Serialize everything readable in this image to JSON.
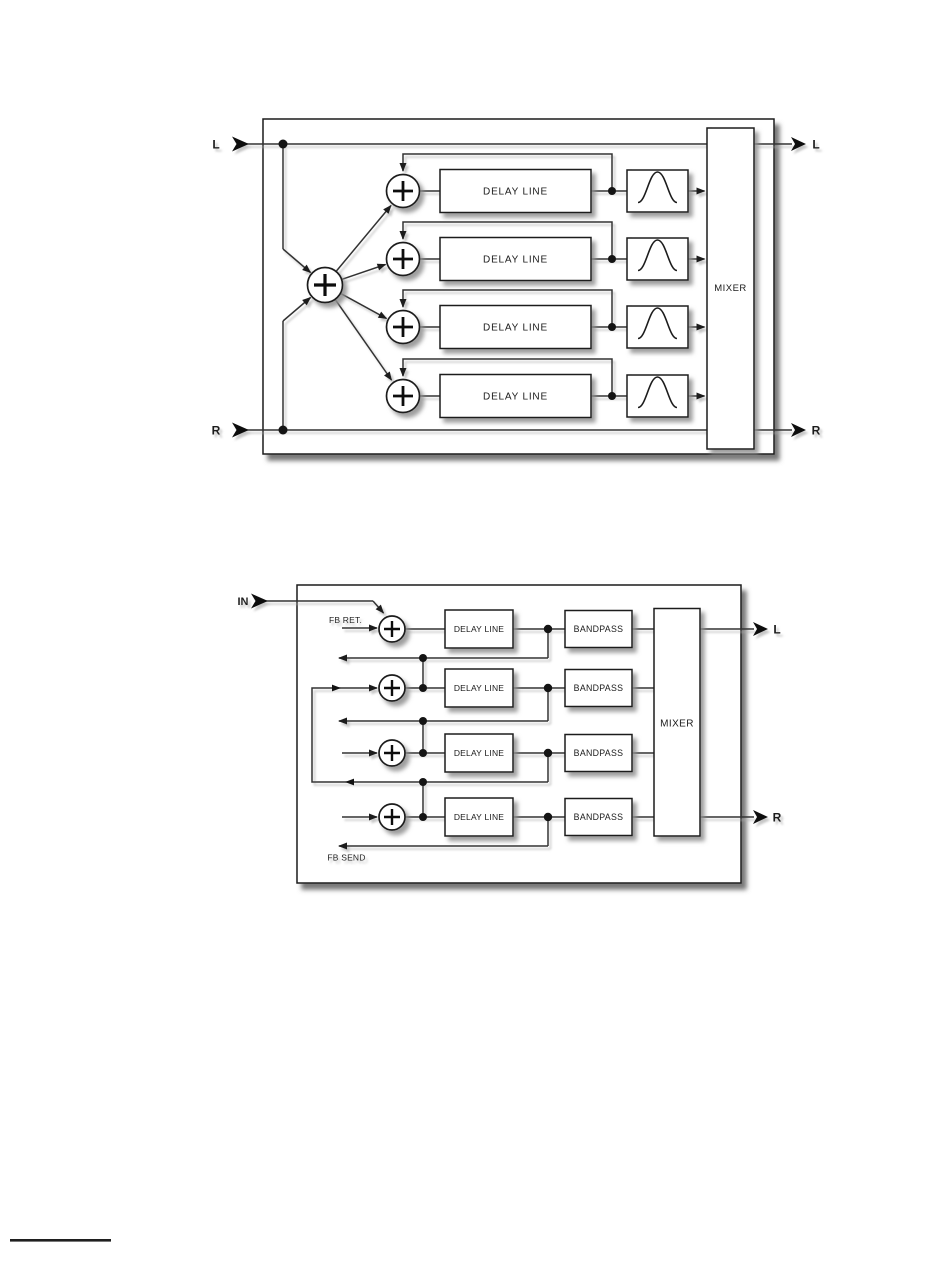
{
  "colors": {
    "background": "#ffffff",
    "line": "#333333",
    "box_stroke": "#1c1c1c",
    "box_fill": "#ffffff",
    "text": "#1a1a1a",
    "shadow": "#8d8d8d"
  },
  "diagram_top": {
    "inputs": {
      "top": "L",
      "bottom": "R"
    },
    "outputs": {
      "top": "L",
      "bottom": "R"
    },
    "summing_symbol": "+",
    "rows": [
      {
        "delay_label": "DELAY LINE",
        "filter_icon": "bandpass-curve-icon"
      },
      {
        "delay_label": "DELAY LINE",
        "filter_icon": "bandpass-curve-icon"
      },
      {
        "delay_label": "DELAY LINE",
        "filter_icon": "bandpass-curve-icon"
      },
      {
        "delay_label": "DELAY LINE",
        "filter_icon": "bandpass-curve-icon"
      }
    ],
    "mixer_label": "MIXER"
  },
  "diagram_bottom": {
    "input_label": "IN",
    "feedback_return_label": "FB RET.",
    "feedback_send_label": "FB SEND",
    "summing_symbol": "+",
    "rows": [
      {
        "delay_label": "DELAY LINE",
        "bandpass_label": "BANDPASS"
      },
      {
        "delay_label": "DELAY LINE",
        "bandpass_label": "BANDPASS"
      },
      {
        "delay_label": "DELAY LINE",
        "bandpass_label": "BANDPASS"
      },
      {
        "delay_label": "DELAY LINE",
        "bandpass_label": "BANDPASS"
      }
    ],
    "mixer_label": "MIXER",
    "outputs": {
      "top": "L",
      "bottom": "R"
    }
  }
}
